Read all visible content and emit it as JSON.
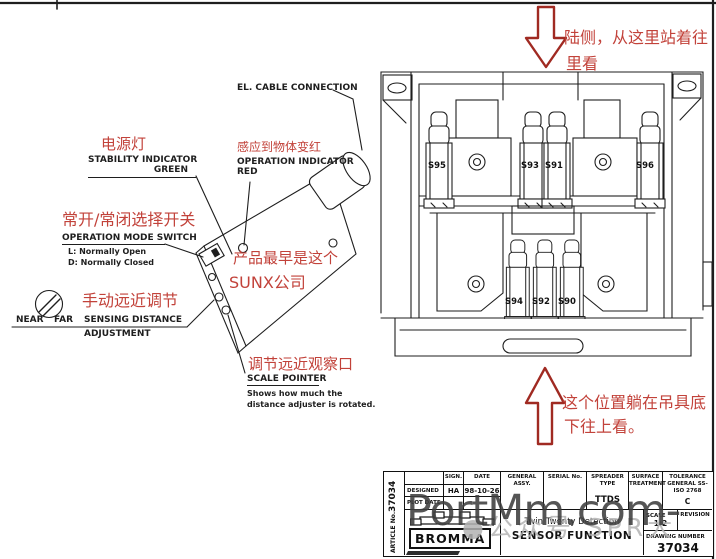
{
  "colors": {
    "annotation_red": "#c2423a",
    "arrow_red": "#a02a22",
    "ink": "#1e1e1e",
    "watermark_dark": "#3e3e3e",
    "watermark_light": "#b3b3b3"
  },
  "left_diagram": {
    "cable_label": "EL. CABLE CONNECTION",
    "power_cn": "电源灯",
    "stability_line1": "STABILITY INDICATOR",
    "stability_line2": "GREEN",
    "sense_red_cn": "感应到物体变红",
    "operation_line1": "OPERATION INDICATOR",
    "operation_line2": "RED",
    "mode_cn": "常开/常闭选择开关",
    "mode_label": "OPERATION MODE SWITCH",
    "mode_open": "L: Normally Open",
    "mode_closed": "D: Normally Closed",
    "adjust_cn": "手动远近调节",
    "near": "NEAR",
    "far": "FAR",
    "sensing_line1": "SENSING DISTANCE",
    "sensing_line2": "ADJUSTMENT",
    "sunx_line1": "产品最早是这个",
    "sunx_line2": "SUNX公司",
    "scale_cn": "调节远近观察口",
    "scale_label": "SCALE POINTER",
    "scale_note1": "Shows how much the",
    "scale_note2": "distance adjuster is rotated."
  },
  "right_diagram": {
    "view_note_line1": "陆侧，从这里站着往",
    "view_note_line2": "里看",
    "bottom_note_line1": "这个位置躺在吊具底",
    "bottom_note_line2": "下往上看。",
    "sensors_top": [
      "S95",
      "S93",
      "S91",
      "S96"
    ],
    "sensors_bottom": [
      "S94",
      "S92",
      "S90"
    ]
  },
  "title_block": {
    "article_no_value": "37034",
    "article_no_label": "ARTICLE No.",
    "sign_header": "SIGN.",
    "date_header": "DATE",
    "designed_label": "DESIGNED",
    "designed_sign": "HA",
    "designed_date": "98-10-26",
    "plot_date_label": "PLOT DATE",
    "general_assy": "GENERAL ASSY.",
    "serial_no": "SERIAL No.",
    "spreader_type_label": "SPREADER TYPE",
    "spreader_type_value": "TTDS",
    "surface_treatment": "SURFACE TREATMENT",
    "tolerance_label": "TOLERANCE GENERAL SS-ISO 2768",
    "tolerance_value": "C",
    "brand": "BROMMA",
    "title_line1": "Twin Twenty Detection",
    "title_line2": "SENSOR FUNCTION",
    "scale_label": "SCALE",
    "scale_value": "1:2",
    "revision_label": "REVISION",
    "drawing_number_label": "DRAWING NUMBER",
    "drawing_number_value": "37034"
  },
  "watermark": {
    "main": "PortMm.com-",
    "faint": "●公众号 SPR大"
  }
}
